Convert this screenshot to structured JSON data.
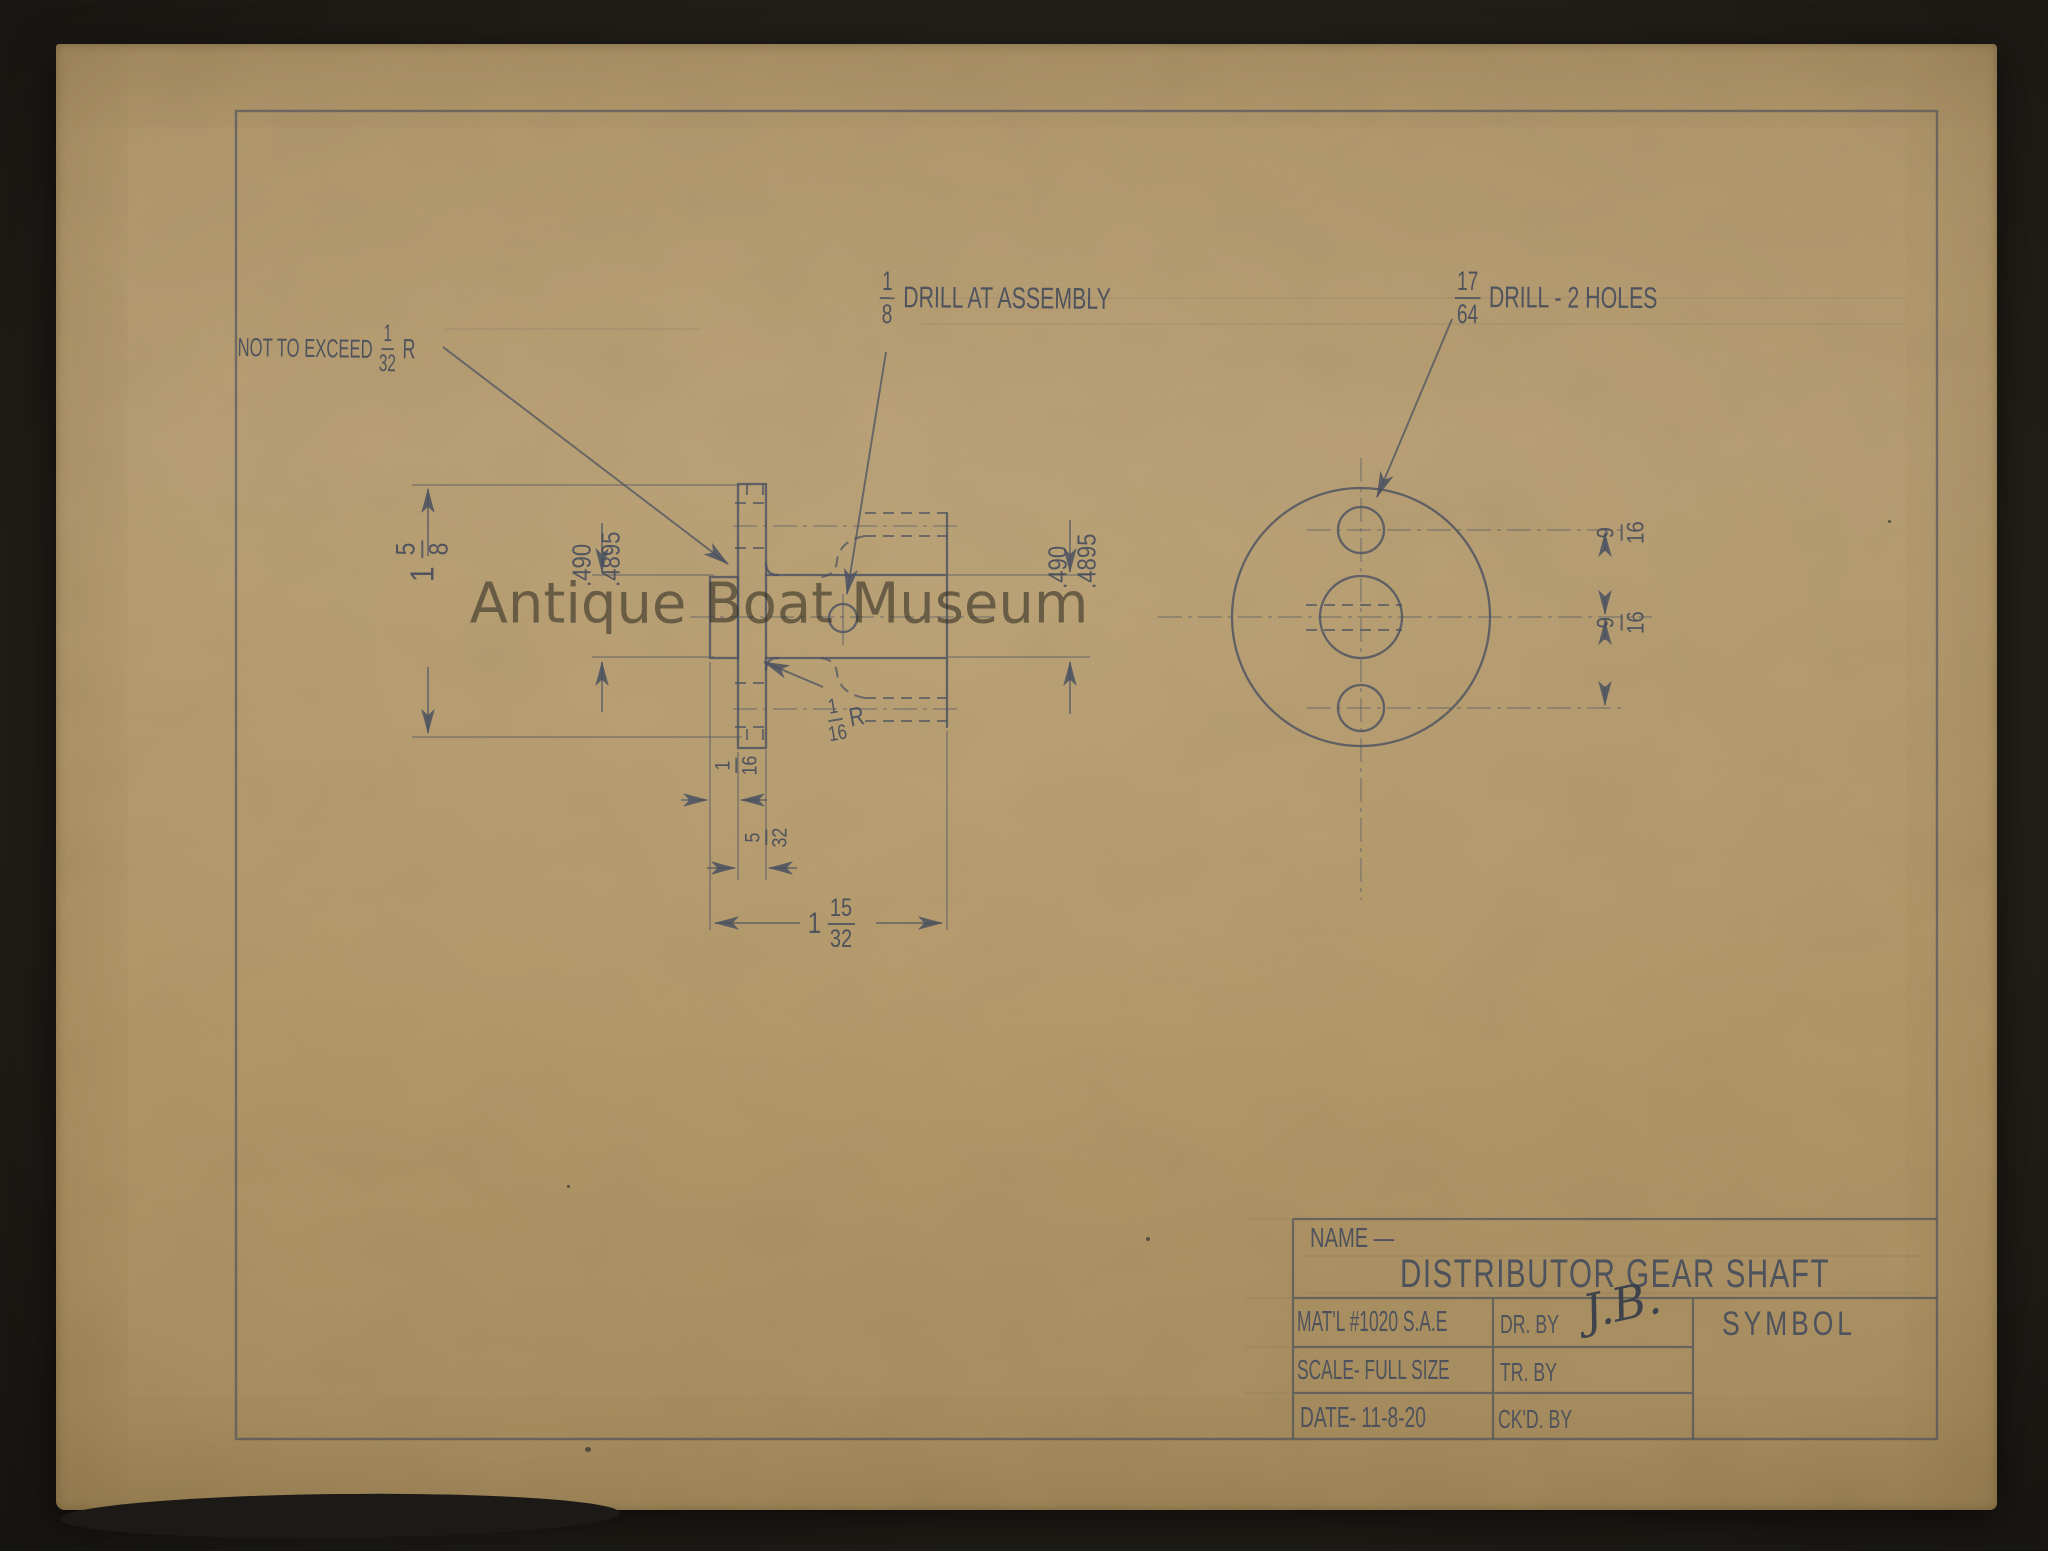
{
  "colors": {
    "paper": "#b69c70",
    "ink": "#4c5360",
    "background": "#22201c",
    "watermark": "#342f26"
  },
  "watermark": {
    "text": "Antique Boat Museum"
  },
  "notes": {
    "fillet_limit": {
      "text": "NOT TO EXCEED",
      "num": "1",
      "den": "32",
      "suffix": "R"
    },
    "drill_assembly": {
      "num": "1",
      "den": "8",
      "text": "DRILL AT ASSEMBLY"
    },
    "drill_two_holes": {
      "num": "17",
      "den": "64",
      "text": "DRILL - 2 HOLES"
    }
  },
  "dims": {
    "flange_od": {
      "whole": "1",
      "num": "5",
      "den": "8"
    },
    "stub_dia": {
      "max": ".490",
      "min": ".4895"
    },
    "shaft_dia": {
      "max": ".490",
      "min": ".4895"
    },
    "offset_upper": {
      "num": "9",
      "den": "16"
    },
    "offset_lower": {
      "num": "9",
      "den": "16"
    },
    "stub_len": {
      "num": "1",
      "den": "16"
    },
    "flange_thk": {
      "num": "5",
      "den": "32"
    },
    "overall_len": {
      "whole": "1",
      "num": "15",
      "den": "32"
    },
    "fillet_radius": {
      "num": "1",
      "den": "16",
      "suffix": "R"
    }
  },
  "title_block": {
    "name_label": "NAME —",
    "part_name": "DISTRIBUTOR GEAR SHAFT",
    "material": "MAT'L #1020 S.A.E",
    "scale": "SCALE- FULL SIZE",
    "date": "DATE- 11-8-20",
    "dr_by_label": "DR. BY",
    "signature": "J.B.",
    "tr_by_label": "TR. BY",
    "ckd_by_label": "CK'D. BY",
    "symbol_label": "SYMBOL"
  }
}
